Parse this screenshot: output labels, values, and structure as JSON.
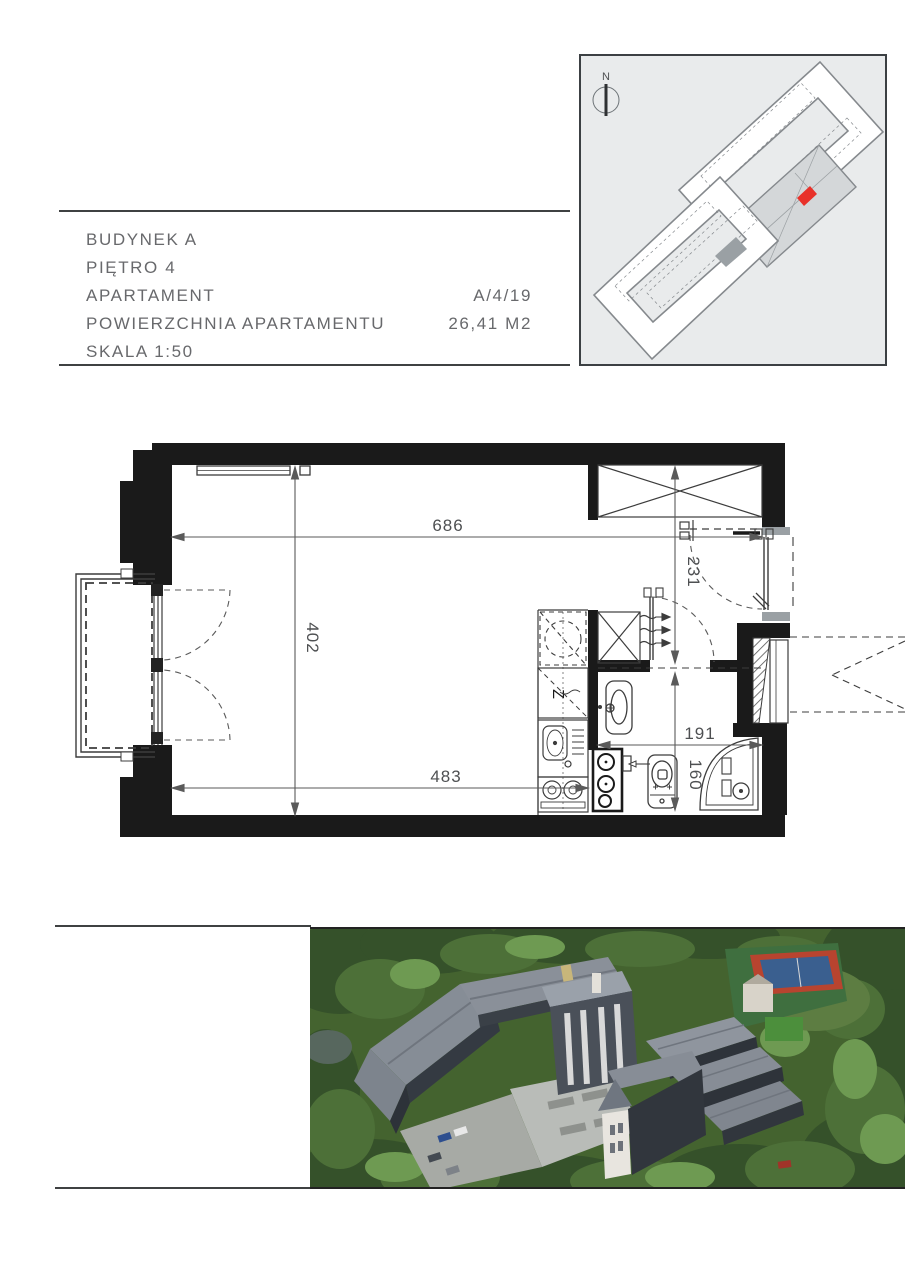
{
  "info": {
    "rows": [
      {
        "label": "BUDYNEK A",
        "value": ""
      },
      {
        "label": "PIĘTRO 4",
        "value": ""
      },
      {
        "label": "APARTAMENT",
        "value": "A/4/19"
      },
      {
        "label": "POWIERZCHNIA APARTAMENTU",
        "value": "26,41 M2"
      },
      {
        "label": "SKALA 1:50",
        "value": ""
      }
    ],
    "text_color": "#68696c"
  },
  "site_plan": {
    "north_label": "N",
    "background": "#e9ebec",
    "outline_color": "#85898d",
    "highlight_unit_color": "#e8312a"
  },
  "floor_plan": {
    "dims": {
      "overall_width": "686",
      "room_height": "402",
      "room_width": "483",
      "hall_depth": "231",
      "bath_width": "191",
      "bath_depth": "160"
    },
    "kitchen": {
      "dishwasher_label": "Z"
    },
    "wall_color": "#1a1a1a",
    "line_color": "#3c3c3c"
  },
  "photo": {
    "description_colors": {
      "forest": "#44632f",
      "roof": "#8d939c",
      "facade": "#31363d",
      "plaza": "#b9bcb8",
      "tennis_red": "#b8442f",
      "tennis_blue": "#3a5f8f"
    }
  }
}
